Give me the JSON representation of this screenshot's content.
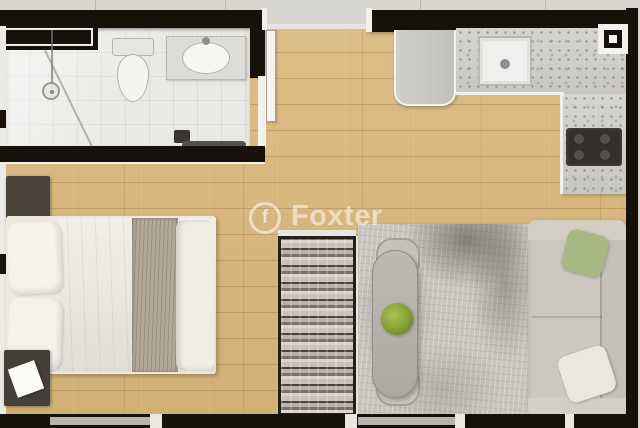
{
  "image_type": "apartment-floor-plan-render",
  "watermark": {
    "brand": "Foxter",
    "logo_glyph": "f"
  },
  "palette": {
    "wall": "#171209",
    "wood_floor": "#d8b77e",
    "bathroom_tile": "#e9e9e6",
    "marble_counter": "#d2d0cb",
    "rug": "#c8c5be",
    "sofa": "#ccc8be",
    "bed_linen": "#ece9e0",
    "bed_runner": "#b3a795",
    "dark_furniture": "#4b443c",
    "plant_green": "#7f9a33",
    "outside": "#d8d6d1"
  },
  "fixtures": [
    "shower",
    "toilet",
    "vanity-sink",
    "bath-window",
    "refrigerator",
    "kitchen-sink",
    "cooktop",
    "corner-window",
    "bed",
    "pillows",
    "nightstands",
    "wardrobe",
    "dining-table",
    "dining-chairs",
    "plant-bowl",
    "rug",
    "sofa",
    "entry-door",
    "bottom-windows"
  ]
}
